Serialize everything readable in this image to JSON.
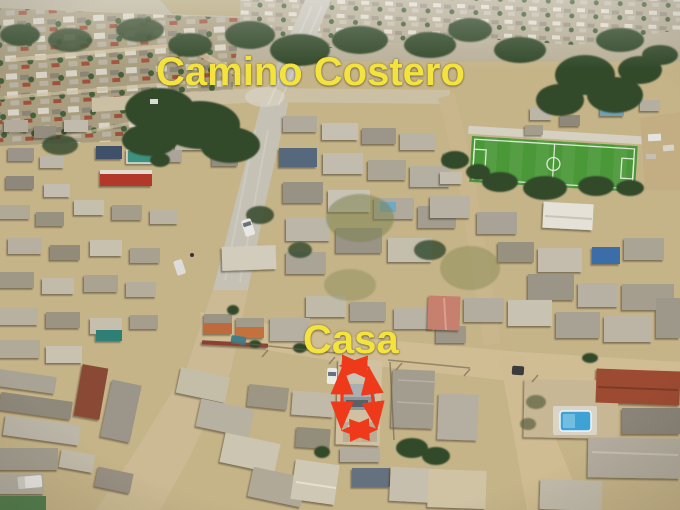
{
  "image": {
    "width_px": 680,
    "height_px": 510
  },
  "annotations": {
    "road_label": "Camino Costero",
    "property_label": "Casa",
    "label_color": "#f4e33c",
    "outline_color": "#ee3a1b"
  },
  "scene": {
    "colors": {
      "sand": "#cbb88d",
      "paved_road": "#c5c1b5",
      "field_green": "#4a9838",
      "tree_green": "#31492a",
      "pool_blue": "#3fa2d4"
    }
  }
}
